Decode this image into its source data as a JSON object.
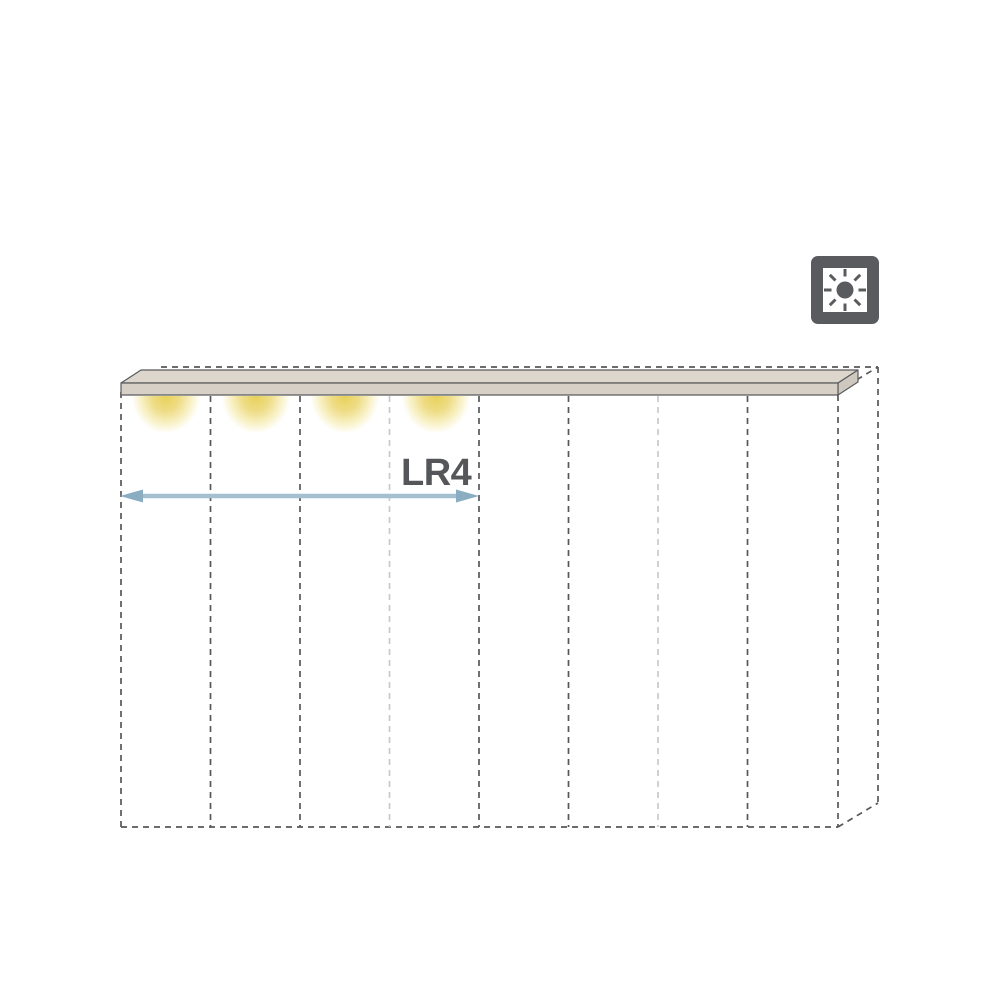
{
  "diagram": {
    "type": "wardrobe front elevation with top LED lighting strip",
    "dimension": {
      "label": "LR4"
    },
    "sections": {
      "count": 8,
      "lit_sections": 4,
      "light_divider_positions": [
        3,
        6
      ]
    },
    "lights": {
      "count": 4,
      "style": "warm LED downlight glow"
    },
    "icon": {
      "name": "interior-light-icon",
      "glyph": "sun in square frame"
    }
  },
  "colors": {
    "outline_dash": "#58585a",
    "outline_dash_light": "#c9c9c9",
    "panel_top": "#ddd6cc",
    "panel_front": "#d7d0c6",
    "panel_side": "#cfc8be",
    "panel_stroke": "#5a5b5e",
    "arrow_shaft": "#a4bfd0",
    "arrow_head": "#8aadc1",
    "label_text": "#55565a",
    "icon": "#595b5f",
    "glow_core": "#e7d159",
    "page_bg": "#ffffff"
  }
}
